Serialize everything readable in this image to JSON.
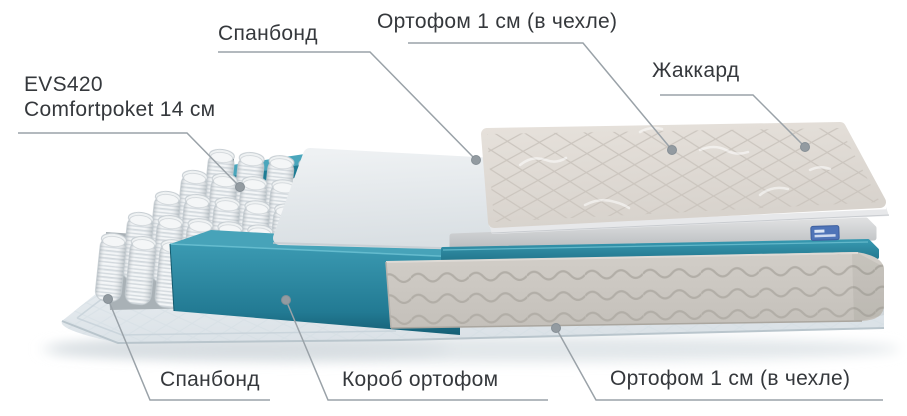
{
  "callouts": {
    "spanbond_top": "Спанбонд",
    "ortofoam_top": "Ортофом 1 см (в чехле)",
    "jacquard": "Жаккард",
    "springs_line1": "EVS420",
    "springs_line2": "Comfortpoket 14 см",
    "spanbond_bottom": "Спанбонд",
    "korob": "Короб ортофом",
    "ortofoam_bottom": "Ортофом 1 см (в чехле)"
  },
  "colors": {
    "background": "#ffffff",
    "text": "#35383c",
    "leader_line": "#9aa2a8",
    "korob_teal": "#2e8da6",
    "jacquard_fabric": "#e0dbd5",
    "ortofoam_side": "#cbc7c1",
    "spanbond_sheet": "#e7edf1",
    "brand_tag_blue": "#4f74b8"
  }
}
